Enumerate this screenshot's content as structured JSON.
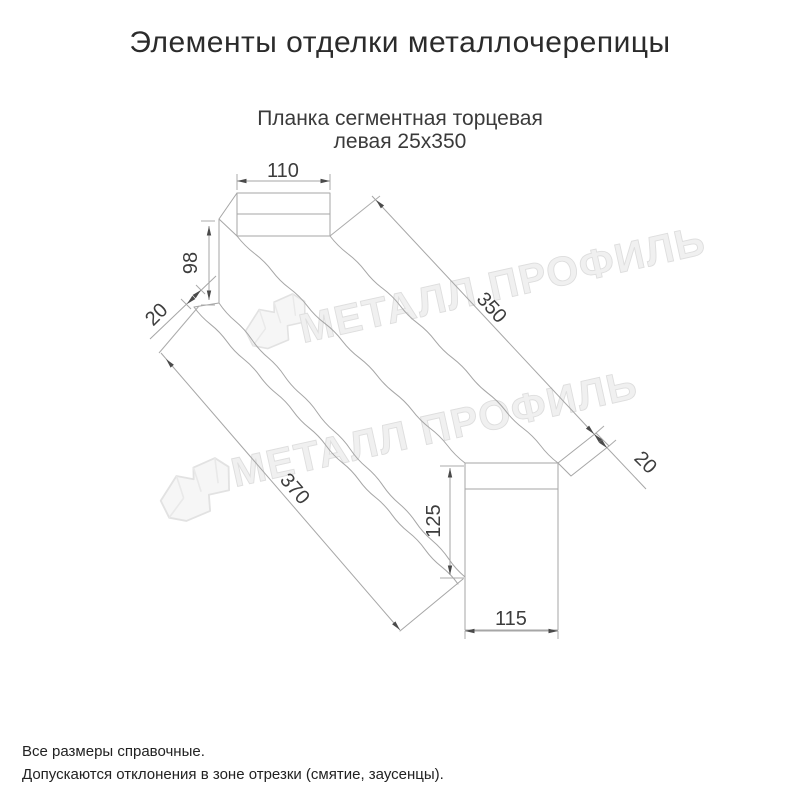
{
  "page": {
    "title": "Элементы отделки металлочерепицы"
  },
  "product": {
    "subtitle_line1": "Планка сегментная торцевая",
    "subtitle_line2": "левая 25х350"
  },
  "drawing": {
    "dimensions": {
      "top_width": "110",
      "left_height": "98",
      "left_hem": "20",
      "top_length": "350",
      "bottom_length": "370",
      "end_height": "125",
      "right_hem": "20",
      "end_width": "115"
    }
  },
  "watermark": {
    "text": "МЕТАЛЛ ПРОФИЛЬ"
  },
  "footnotes": {
    "line1": "Все размеры справочные.",
    "line2": "Допускаются отклонения в зоне отрезки (смятие, заусенцы)."
  },
  "colors": {
    "line": "#a6a6a6",
    "dimension_text": "#3d3d3d",
    "title_text": "#2b2b2b",
    "watermark": "#efefef"
  }
}
